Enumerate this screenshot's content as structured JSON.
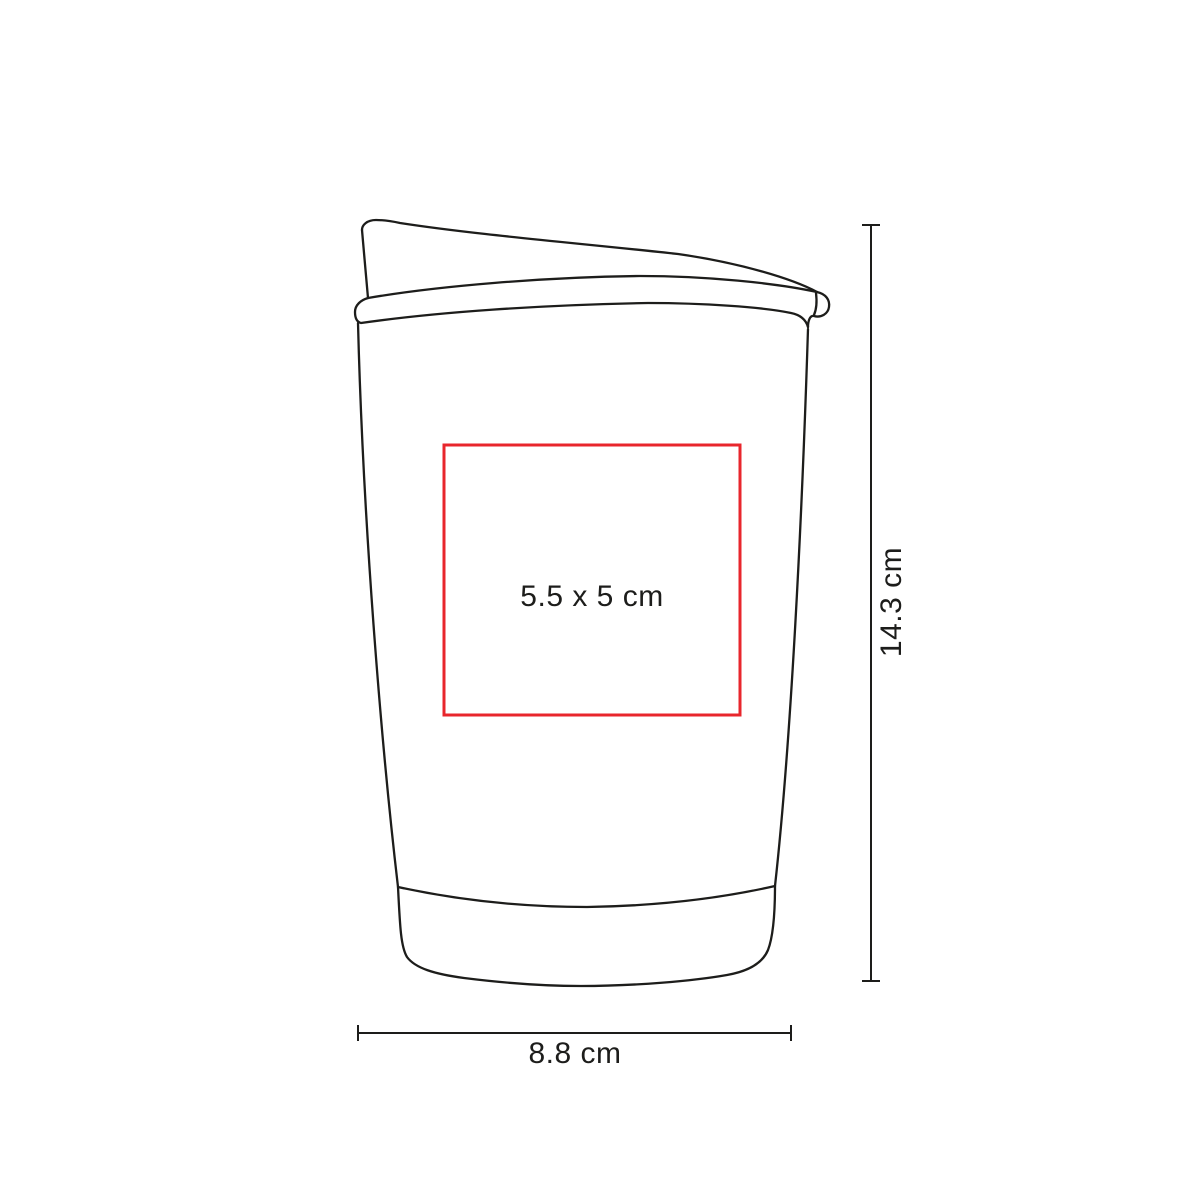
{
  "page": {
    "background_color": "#ffffff"
  },
  "illustration": {
    "name": "travel-tumbler-with-sloped-lid-line-drawing",
    "line_color": "#1d1d1b"
  },
  "print_area": {
    "label": "5.5 x 5 cm",
    "width_cm": 5.5,
    "height_cm": 5,
    "border_color": "#e8262c"
  },
  "dimensions": {
    "height": {
      "label": "14.3 cm",
      "value_cm": 14.3
    },
    "width": {
      "label": "8.8 cm",
      "value_cm": 8.8
    }
  },
  "text_color": "#1d1d1b"
}
